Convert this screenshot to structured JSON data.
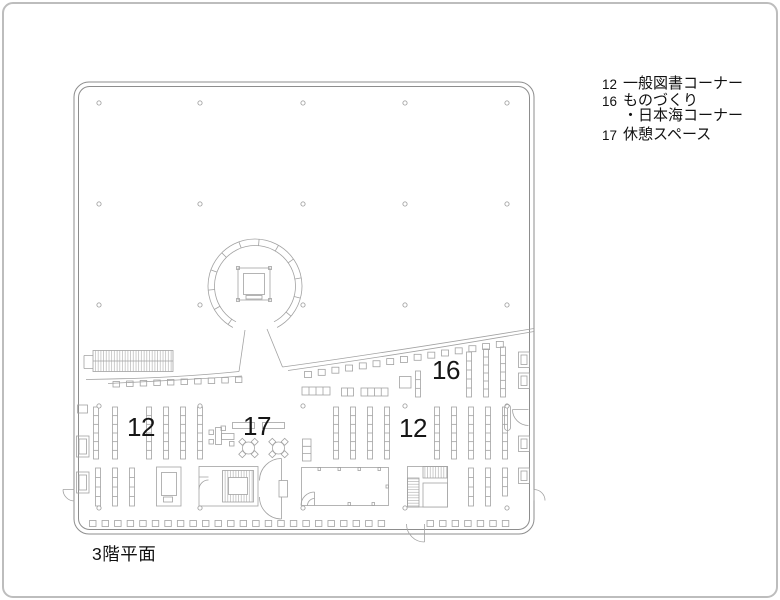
{
  "page": {
    "title": "3階平面"
  },
  "plan": {
    "floor_label": "3階平面",
    "area_labels": {
      "general_books_left": "12",
      "rest_space": "17",
      "monozukuri_japansea": "16",
      "general_books_right": "12"
    }
  },
  "legend": {
    "items": [
      {
        "num": "12",
        "line1": "一般図書コーナー",
        "line2": ""
      },
      {
        "num": "16",
        "line1": "ものづくり",
        "line2": "・日本海コーナー"
      },
      {
        "num": "17",
        "line1": "休憩スペース",
        "line2": ""
      }
    ]
  },
  "colors": {
    "background": "#ffffff",
    "furniture_line": "#a2a2a2",
    "wall_line": "#8d8d8d",
    "frame_border": "#bdbdbd",
    "text": "#161616"
  }
}
